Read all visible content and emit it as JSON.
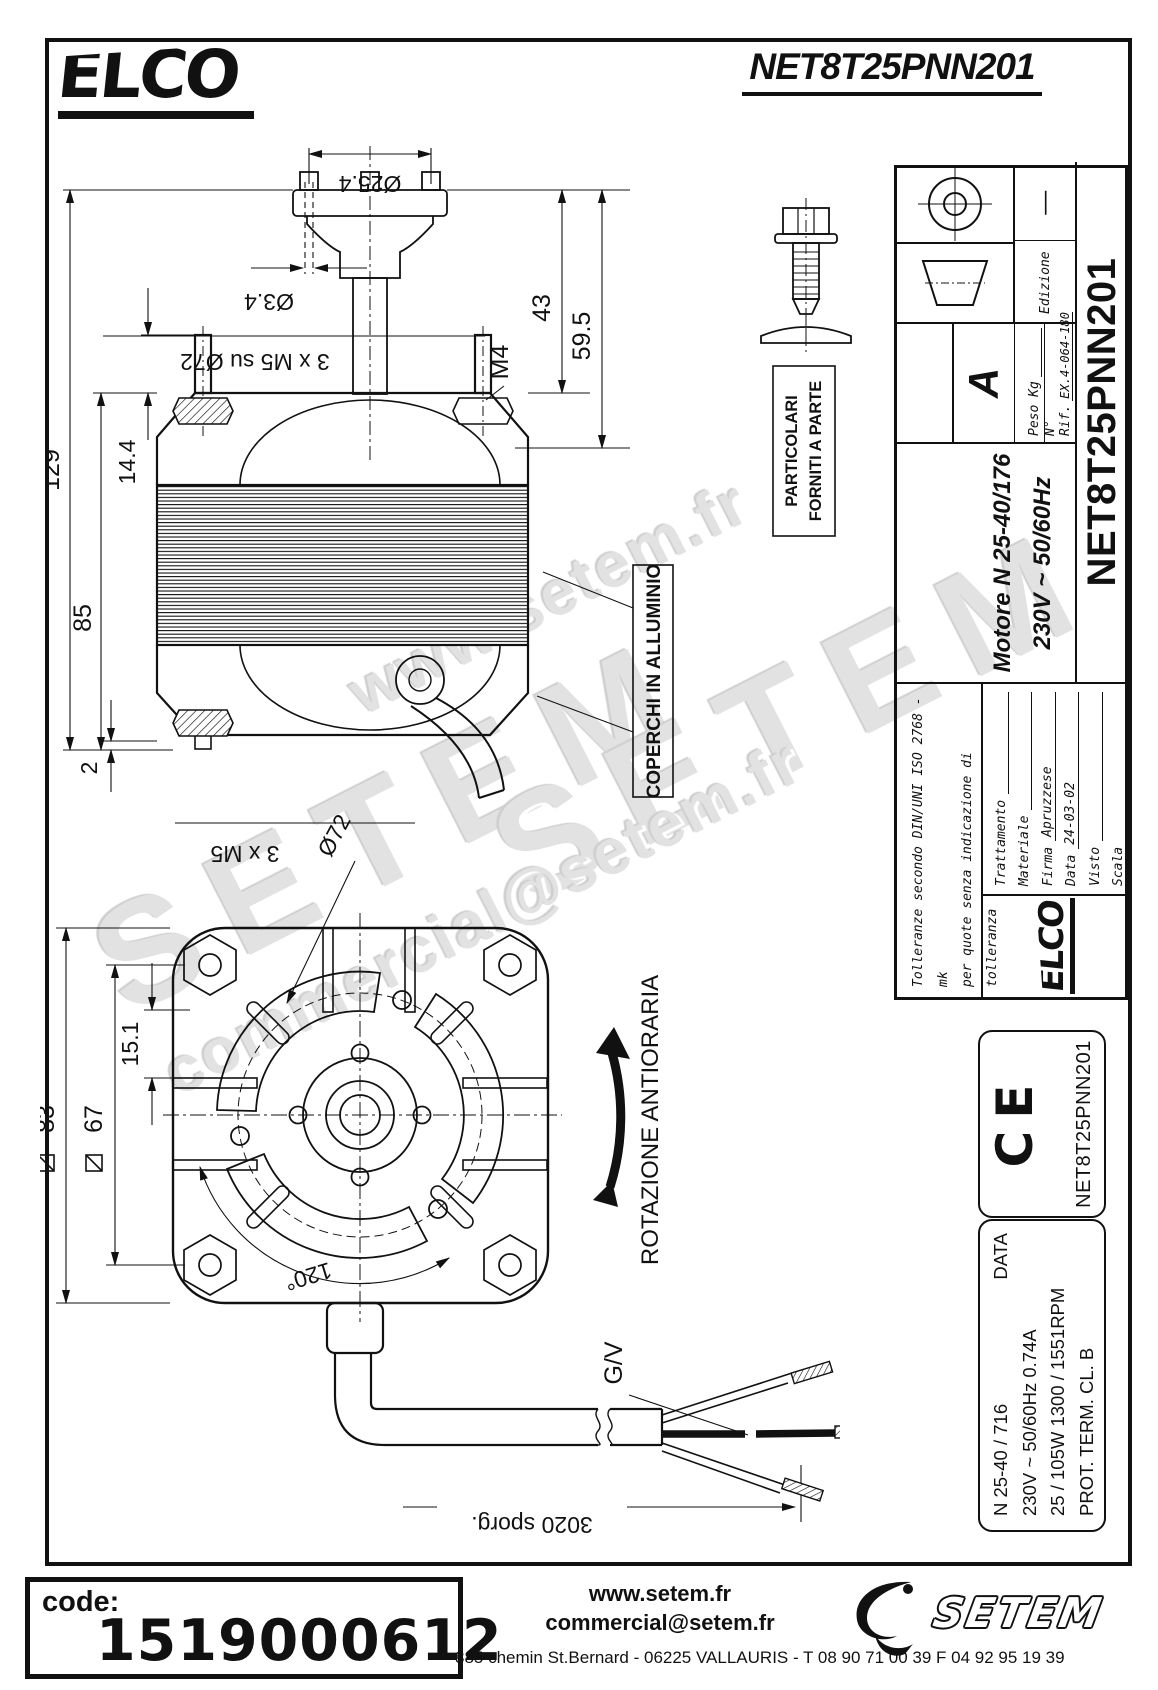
{
  "colors": {
    "line": "#111111",
    "watermark": "#e2e2e2"
  },
  "header": {
    "logo_text": "ELCO",
    "drawing_title": "NET8T25PNN201"
  },
  "watermarks": {
    "w1": "www.setem.fr",
    "w2": "SETEM",
    "w3": "SETEM",
    "w4": "commercial@setem.fr"
  },
  "side_view": {
    "dim_hub": "Ø25.4",
    "dim_hole": "Ø3.4",
    "dim_studs_top": "3 x M5 su Ø72",
    "dim_thread": "M4",
    "dim_43": "43",
    "dim_59_5": "59.5",
    "dim_14_4": "14.4",
    "dim_129": "129",
    "dim_85": "85",
    "dim_2": "2",
    "dim_studs_bottom": "3 x M5",
    "covers_note": "COPERCHI IN ALLUMINIO",
    "parts_note_line1": "PARTICOLARI",
    "parts_note_line2": "FORNITI A PARTE"
  },
  "front_view": {
    "dim_square_83": "83",
    "dim_square_67": "67",
    "dim_15_1": "15.1",
    "dim_bolt_circle": "Ø72",
    "dim_angle": "120°",
    "rotation_note": "ROTAZIONE ANTIORARIA",
    "wire_label": "G/V",
    "dim_cable": "3020 sporg."
  },
  "title_block": {
    "tolerance_note_line1": "Tolleranze secondo DIN/UNI ISO 2768 - mk",
    "tolerance_note_line2": "per quote senza indicazione di tolleranza",
    "treatment_label": "Trattamento",
    "material_label": "Materiale",
    "signature_label": "Firma",
    "signature_value": "Apruzzese",
    "date_label": "Data",
    "date_value": "24-03-02",
    "approved_label": "Visto",
    "scale_label": "Scala",
    "product_line1": "Motore  N 25-40/176",
    "product_line2": "230V ~  50/60Hz",
    "revision": "A",
    "weight_label": "Peso Kg",
    "ref_label": "N° Rif.",
    "ref_value": "EX.4-064-180",
    "edition_label": "Edizione",
    "edition_value": "—",
    "drawing_number": "NET8T25PNN201",
    "logo_text": "ELCO"
  },
  "ce_box": {
    "mark": "CE",
    "drawing_number": "NET8T25PNN201"
  },
  "data_box": {
    "header": "DATA",
    "model": "N 25-40 / 716",
    "electrical": "230V ~  50/60Hz   0.74A",
    "power_speed": "25 / 105W   1300 / 1551RPM",
    "protection": "PROT. TERM.   CL. B"
  },
  "footer": {
    "code_label": "code:",
    "code_value": "1519000612",
    "website": "www.setem.fr",
    "email": "commercial@setem.fr",
    "address": "885 chemin St.Bernard  -  06225 VALLAURIS  -  T 08 90 71 00 39   F 04 92 95 19 39",
    "logo_text": "SETEM"
  }
}
